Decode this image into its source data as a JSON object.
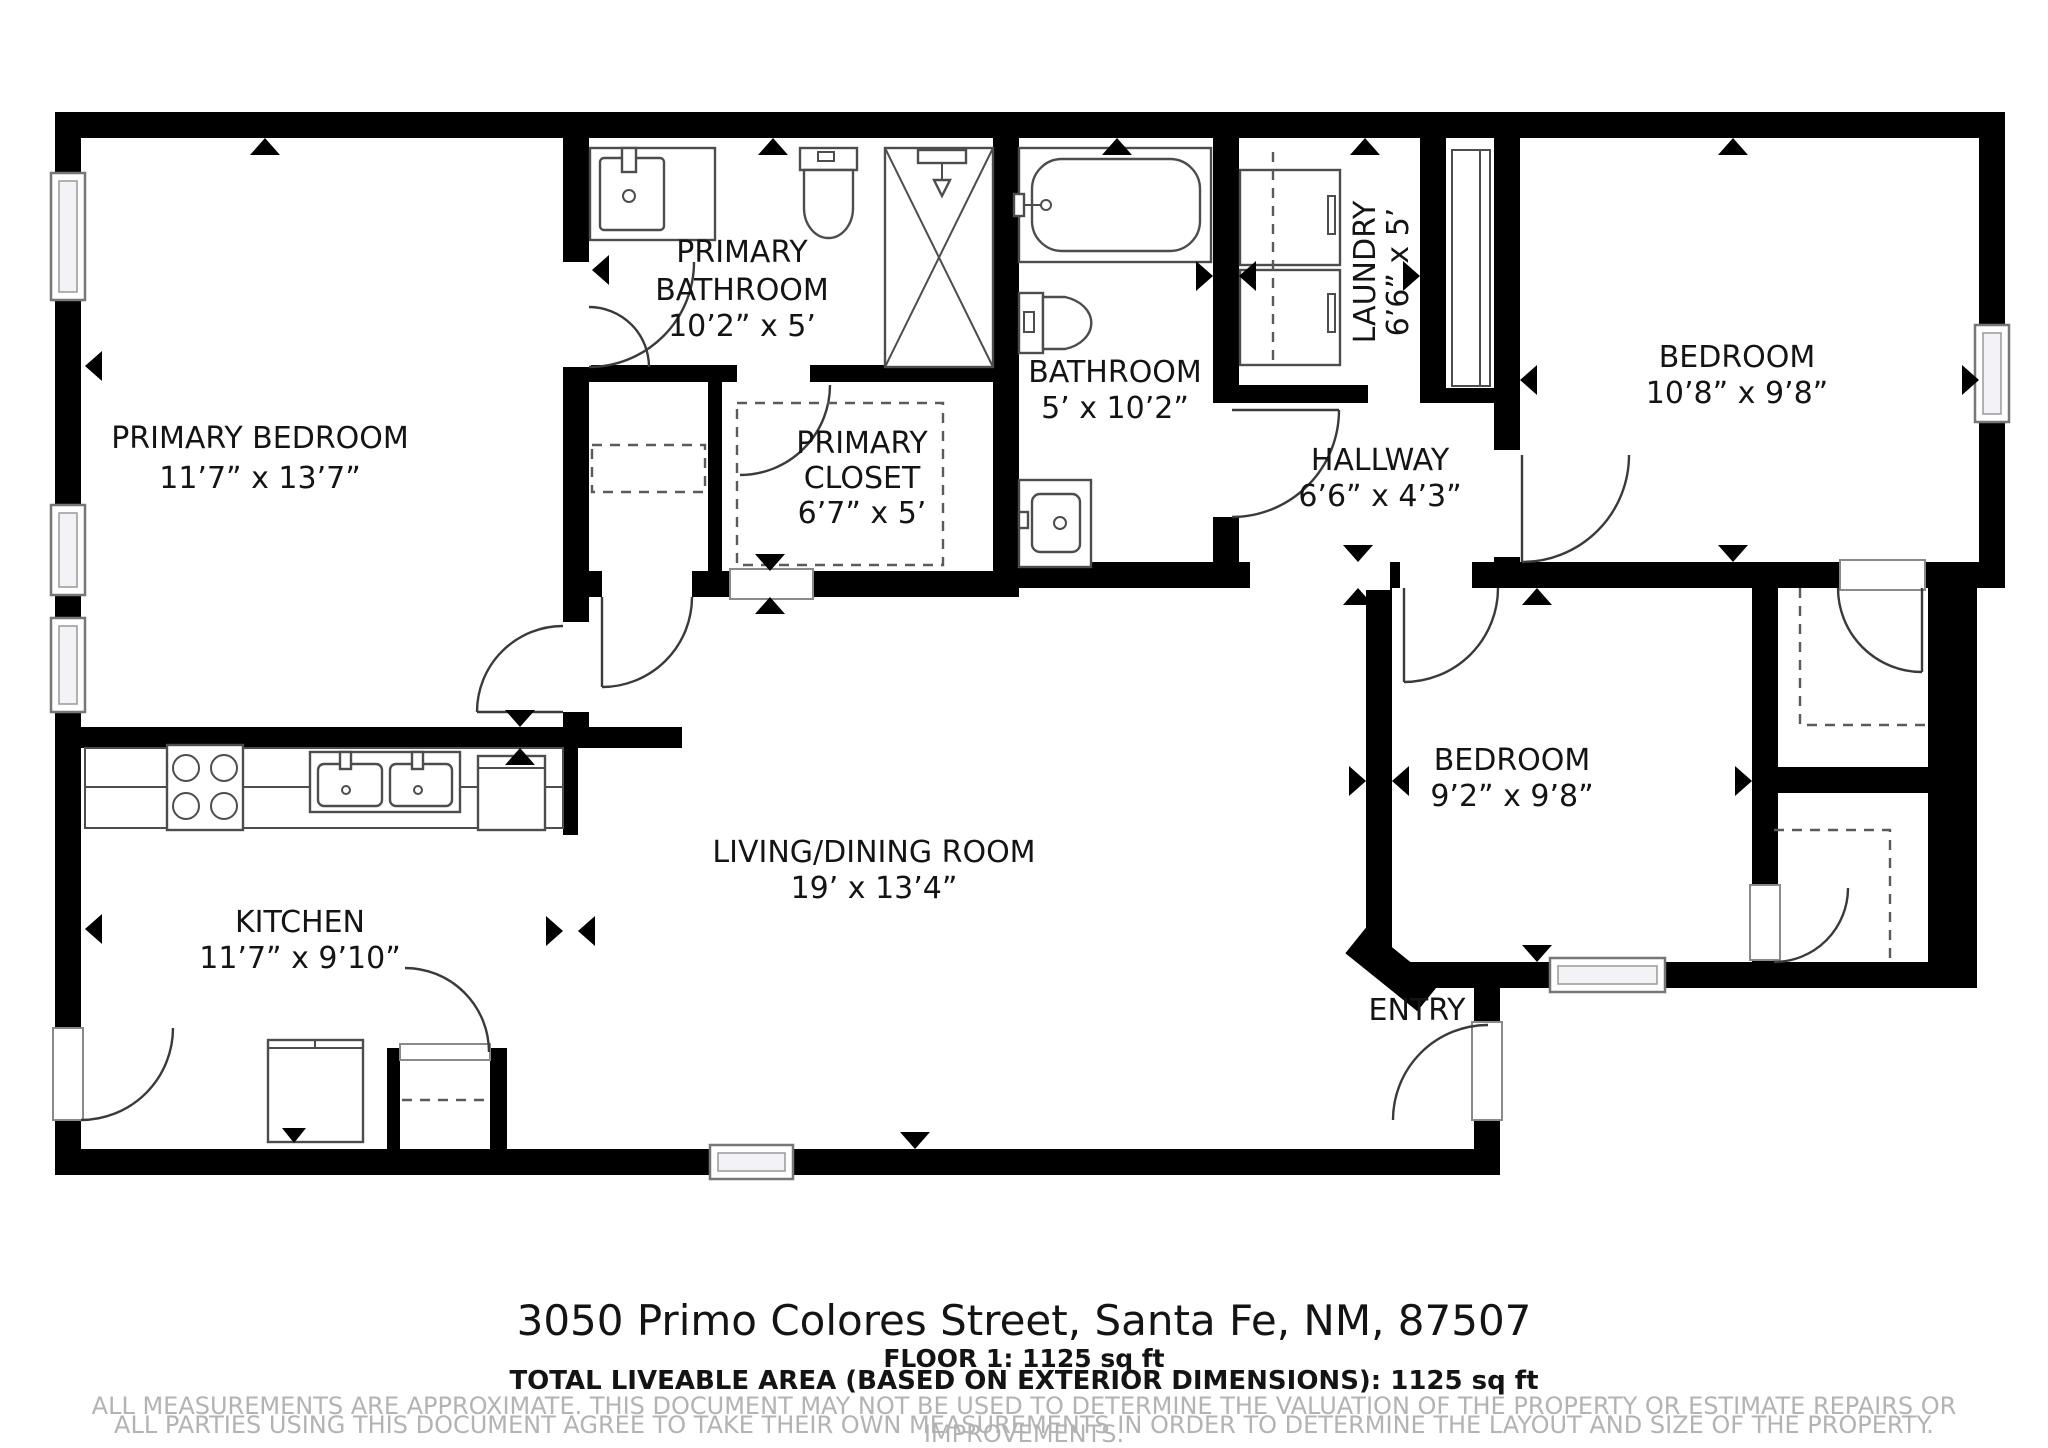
{
  "plan": {
    "rooms": [
      {
        "name": "PRIMARY BEDROOM",
        "dims": "11’7” x 13’7”",
        "lines": [
          "PRIMARY BEDROOM",
          "11’7” x 13’7”"
        ]
      },
      {
        "name": "PRIMARY BATHROOM",
        "dims": "10’2” x 5’",
        "lines": [
          "PRIMARY",
          "BATHROOM",
          "10’2” x 5’"
        ]
      },
      {
        "name": "PRIMARY CLOSET",
        "dims": "6’7” x 5’",
        "lines": [
          "PRIMARY",
          "CLOSET",
          "6’7” x 5’"
        ]
      },
      {
        "name": "BATHROOM",
        "dims": "5’ x 10’2”",
        "lines": [
          "BATHROOM",
          "5’ x 10’2”"
        ]
      },
      {
        "name": "LAUNDRY",
        "dims": "6’6” x 5’",
        "lines": [
          "LAUNDRY",
          "6’6” x 5’"
        ]
      },
      {
        "name": "HALLWAY",
        "dims": "6’6” x 4’3”",
        "lines": [
          "HALLWAY",
          "6’6” x 4’3”"
        ]
      },
      {
        "name": "BEDROOM",
        "dims": "10’8” x 9’8”",
        "lines": [
          "BEDROOM",
          "10’8” x 9’8”"
        ]
      },
      {
        "name": "BEDROOM",
        "dims": "9’2” x 9’8”",
        "lines": [
          "BEDROOM",
          "9’2” x 9’8”"
        ]
      },
      {
        "name": "LIVING/DINING ROOM",
        "dims": "19’ x 13’4”",
        "lines": [
          "LIVING/DINING ROOM",
          "19’ x 13’4”"
        ]
      },
      {
        "name": "KITCHEN",
        "dims": "11’7” x 9’10”",
        "lines": [
          "KITCHEN",
          "11’7” x 9’10”"
        ]
      },
      {
        "name": "ENTRY",
        "dims": "",
        "lines": [
          "ENTRY"
        ]
      }
    ],
    "footer": {
      "address": "3050 Primo Colores Street, Santa Fe, NM, 87507",
      "floor_line": "FLOOR 1: 1125 sq ft",
      "total_line": "TOTAL LIVEABLE AREA (BASED ON EXTERIOR DIMENSIONS): 1125 sq ft",
      "disclaimer_line1": "ALL MEASUREMENTS ARE APPROXIMATE. THIS DOCUMENT MAY NOT BE USED TO DETERMINE THE VALUATION OF THE PROPERTY OR ESTIMATE REPAIRS OR IMPROVEMENTS.",
      "disclaimer_line2": "ALL PARTIES USING THIS DOCUMENT AGREE TO TAKE THEIR OWN MEASUREMENTS IN ORDER TO DETERMINE THE LAYOUT AND SIZE OF THE PROPERTY."
    },
    "colors": {
      "wall": "#000000",
      "label_text": "#141414",
      "disclaimer_text": "#b3b3b3",
      "fixture_stroke": "#4d4d4d"
    }
  }
}
